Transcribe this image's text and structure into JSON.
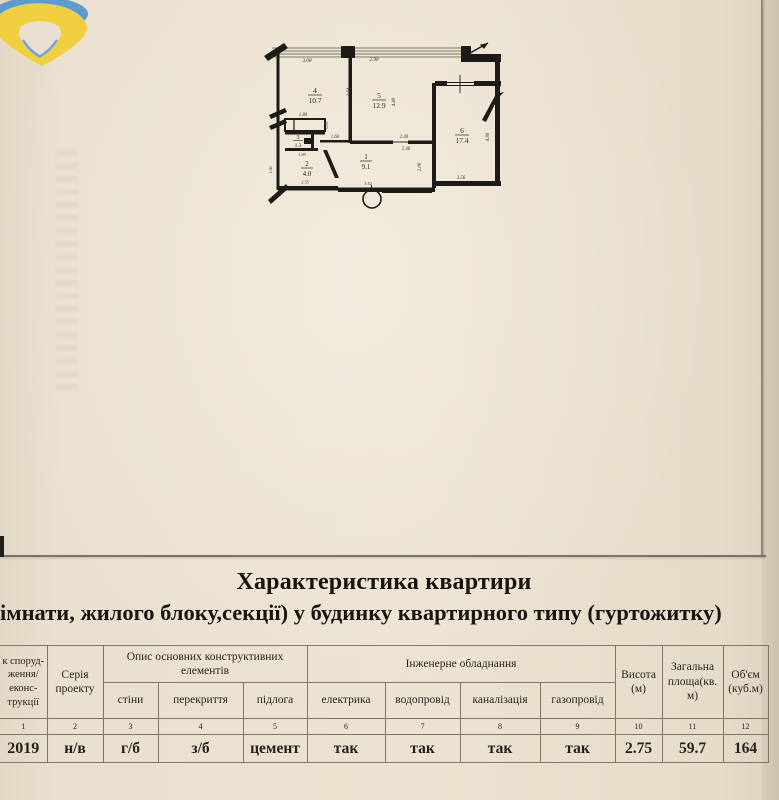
{
  "page": {
    "title": "Характеристика квартири",
    "subtitle": "імнати, жилого блоку,секції) у будинку квартирного типу (гуртожитку)"
  },
  "plan": {
    "rooms": {
      "r1": {
        "num": "1",
        "area": "9.1"
      },
      "r2": {
        "num": "2",
        "area": "4.0"
      },
      "r3": {
        "num": "3",
        "area": "1.3"
      },
      "r4": {
        "num": "4",
        "area": "10.7"
      },
      "r5": {
        "num": "5",
        "area": "12.9"
      },
      "r6": {
        "num": "6",
        "area": "17.4"
      }
    },
    "dims": {
      "top_left": "3.08",
      "top_mid": "2.98",
      "wall_45": "3.64",
      "r5_depth": "4.40",
      "wardrobe_w": "1.80",
      "wardrobe_d": "0.81",
      "hall_niche": "1.60",
      "r3_w": "1.85",
      "r2_left": "1.66",
      "r2_bottom": "2.55",
      "hall_w_top": "2.40",
      "hall_w_bot": "2.46",
      "hall_bottom": "3.52",
      "hall_right": "2.08",
      "r6_right": "4.88",
      "r6_bottom": "3.56"
    }
  },
  "table": {
    "headers": {
      "col1_lines": [
        "к споруд-",
        "ження/",
        "еконс-",
        "трукції"
      ],
      "col2": "Серія проекту",
      "group_constr": "Опис основних конструктивних елементів",
      "group_eng": "Інженерне обладнання",
      "sub": [
        "стіни",
        "перекриття",
        "підлога",
        "електрика",
        "водопровід",
        "каналізація",
        "газопровід"
      ],
      "col10": "Висота (м)",
      "col11": "Загальна площа(кв. м)",
      "col12": "Об'єм (куб.м)"
    },
    "numbers": [
      "1",
      "2",
      "3",
      "4",
      "5",
      "6",
      "7",
      "8",
      "9",
      "10",
      "11",
      "12"
    ],
    "values": [
      "2019",
      "н/в",
      "г/б",
      "з/б",
      "цемент",
      "так",
      "так",
      "так",
      "так",
      "2.75",
      "59.7",
      "164"
    ]
  },
  "colors": {
    "logo_blue": "#5b9bd0",
    "logo_yellow": "#f0cf3e",
    "paper_beige": "#e9dfce",
    "line_gray": "#7f7668",
    "ink_black": "#211d18"
  }
}
